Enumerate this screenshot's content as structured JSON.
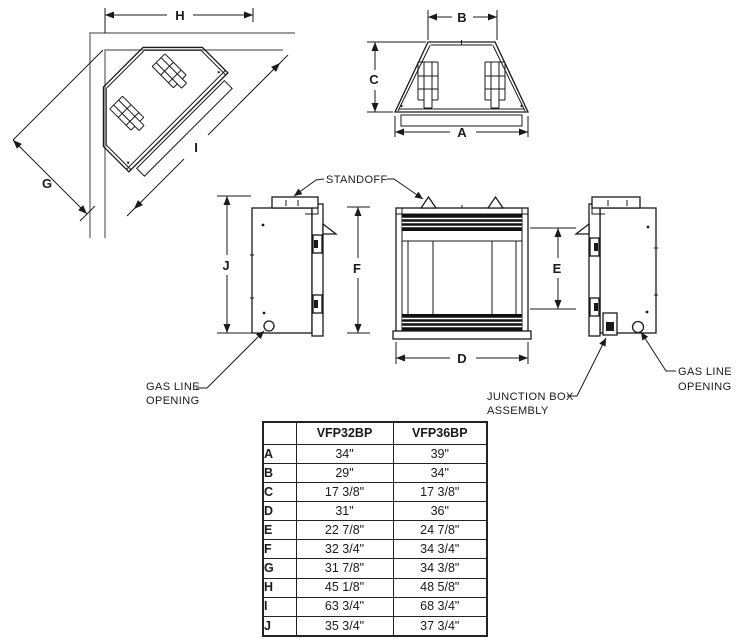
{
  "dims": {
    "A": "A",
    "B": "B",
    "C": "C",
    "D": "D",
    "E": "E",
    "F": "F",
    "G": "G",
    "H": "H",
    "I": "I",
    "J": "J"
  },
  "labels": {
    "standoff": "STANDOFF",
    "gas_line_line1": "GAS LINE",
    "gas_line_line2": "OPENING",
    "junction_line1": "JUNCTION BOX",
    "junction_line2": "ASSEMBLY"
  },
  "table": {
    "columns": [
      "",
      "VFP32BP",
      "VFP36BP"
    ],
    "rows": [
      {
        "dim": "A",
        "vfp32bp": "34\"",
        "vfp36bp": "39\""
      },
      {
        "dim": "B",
        "vfp32bp": "29\"",
        "vfp36bp": "34\""
      },
      {
        "dim": "C",
        "vfp32bp": "17 3/8\"",
        "vfp36bp": "17 3/8\""
      },
      {
        "dim": "D",
        "vfp32bp": "31\"",
        "vfp36bp": "36\""
      },
      {
        "dim": "E",
        "vfp32bp": "22 7/8\"",
        "vfp36bp": "24 7/8\""
      },
      {
        "dim": "F",
        "vfp32bp": "32 3/4\"",
        "vfp36bp": "34 3/4\""
      },
      {
        "dim": "G",
        "vfp32bp": "31 7/8\"",
        "vfp36bp": "34 3/8\""
      },
      {
        "dim": "H",
        "vfp32bp": "45 1/8\"",
        "vfp36bp": "48 5/8\""
      },
      {
        "dim": "I",
        "vfp32bp": "63 3/4\"",
        "vfp36bp": "68 3/4\""
      },
      {
        "dim": "J",
        "vfp32bp": "35 3/4\"",
        "vfp36bp": "37 3/4\""
      }
    ]
  },
  "colors": {
    "line": "#1a1a1a",
    "wall": "#8f8f8f",
    "louver": "#111111"
  }
}
